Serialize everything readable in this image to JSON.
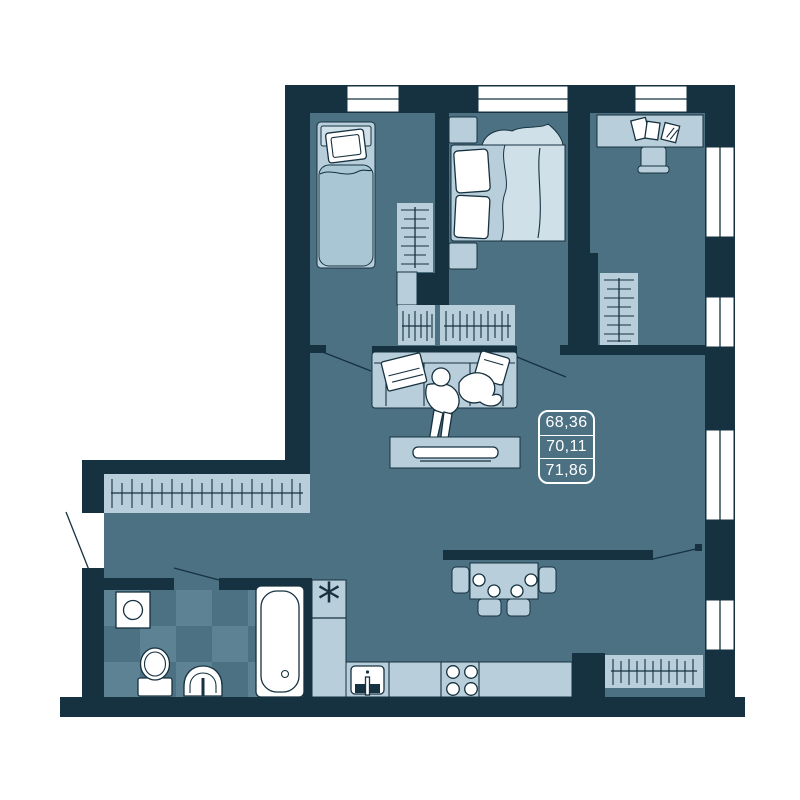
{
  "document": {
    "kind": "apartment floor plan drawing"
  },
  "area_label": {
    "values": [
      "68,36",
      "70,11",
      "71,86"
    ]
  },
  "symbols": {
    "kitchen_marker": "*"
  },
  "colors": {
    "background": "#ffffff",
    "wall": "#16313f",
    "floor": "#4c7183",
    "tile_light": "#5d8294",
    "furniture": "#b8cfdb",
    "furniture_light": "#cfe0e8",
    "bedding": "#a9c6d4",
    "white": "#ffffff",
    "outline": "#16313f"
  },
  "icons": [
    "single-bed-icon",
    "double-bed-icon",
    "nightstand-icon",
    "wardrobe-icon",
    "desk-icon",
    "office-chair-icon",
    "papers-icon",
    "sofa-icon",
    "person-icon",
    "pillow-icon",
    "throw-blanket-icon",
    "coffee-table-icon",
    "tray-icon",
    "dining-table-icon",
    "chair-icon",
    "plate-icon",
    "kitchen-sink-icon",
    "stove-icon",
    "asterisk-icon",
    "bathtub-icon",
    "toilet-icon",
    "washbasin-icon",
    "washing-machine-icon",
    "window-icon",
    "door-swing-icon"
  ]
}
